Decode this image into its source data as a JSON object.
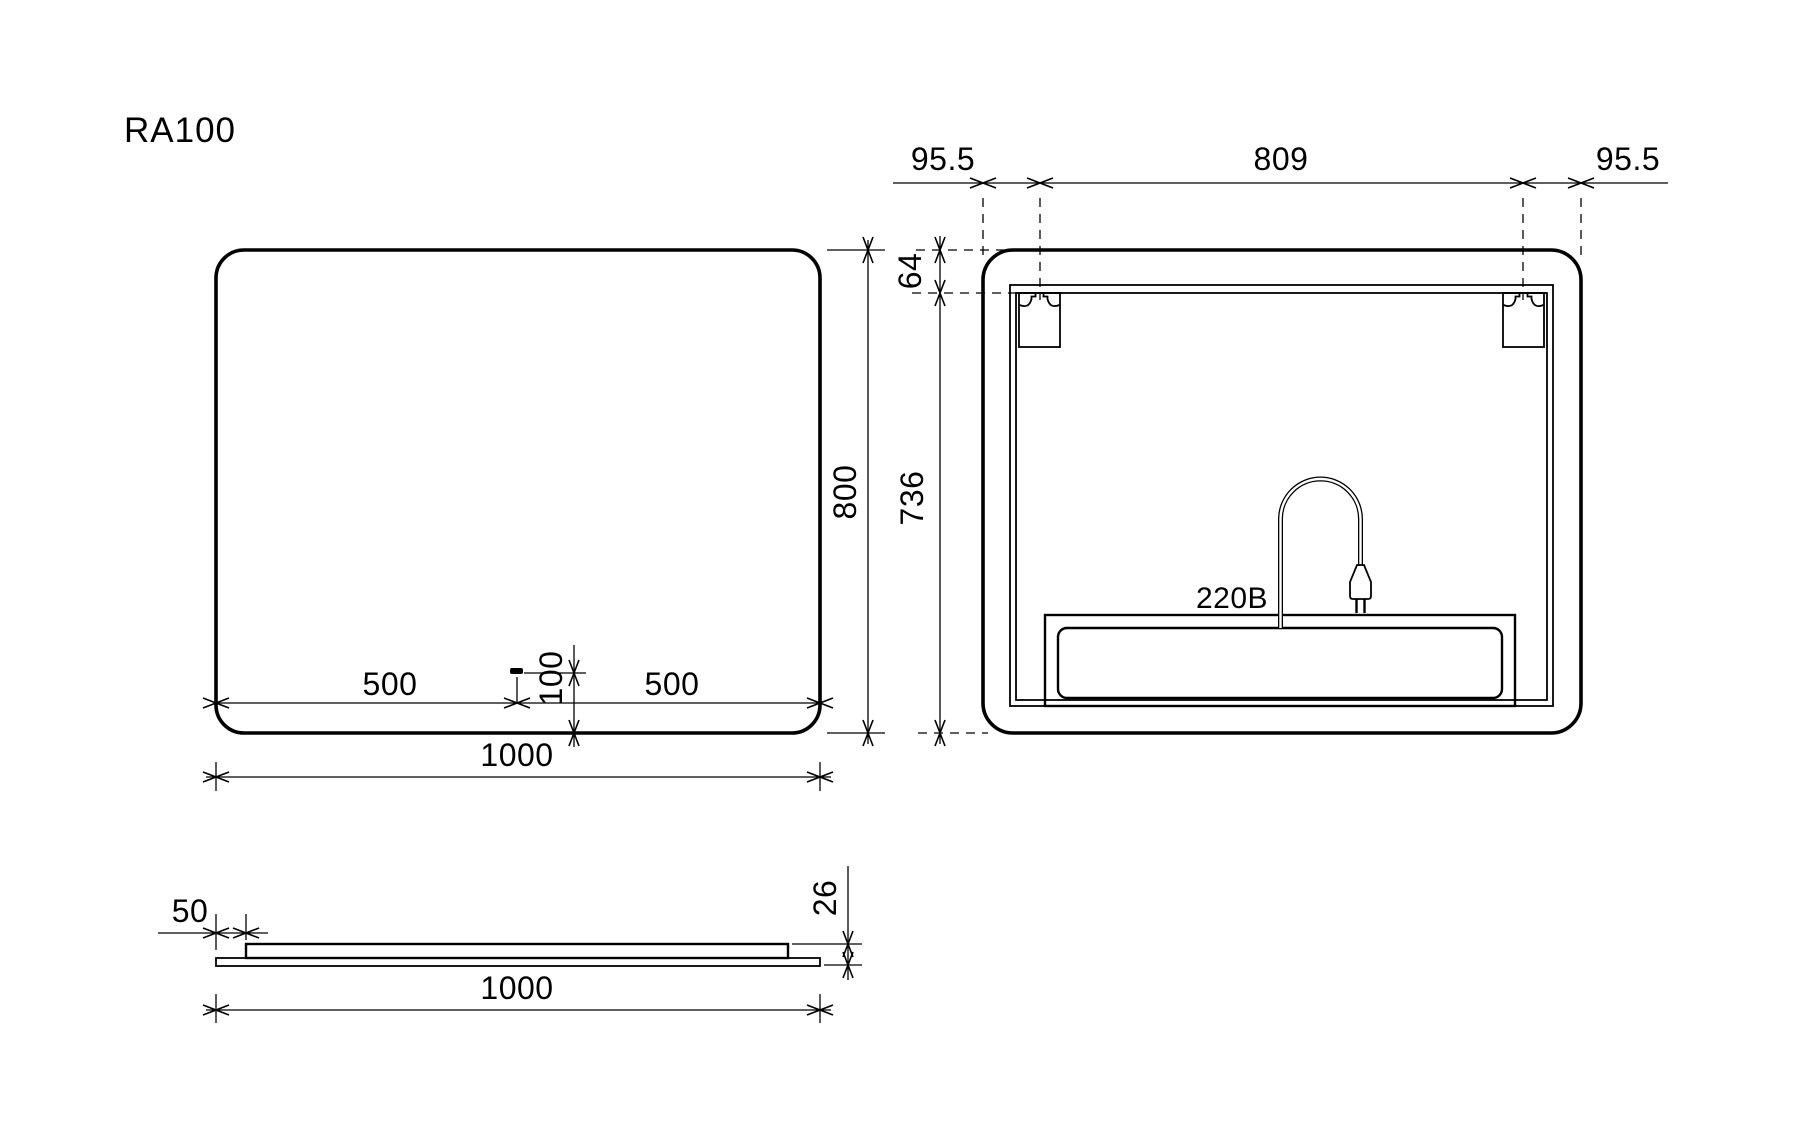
{
  "title": "RA100",
  "front_view": {
    "dim_width": "1000",
    "dim_height": "800",
    "dim_sensor_left": "500",
    "dim_sensor_right": "500",
    "dim_sensor_bottom": "100"
  },
  "back_view": {
    "dim_edge_left": "95.5",
    "dim_brackets": "809",
    "dim_edge_right": "95.5",
    "dim_top": "64",
    "dim_bottom": "736",
    "voltage_label": "220B"
  },
  "side_view": {
    "dim_inset": "50",
    "dim_width": "1000",
    "dim_thickness": "26"
  },
  "colors": {
    "line": "#000000",
    "background": "#ffffff"
  }
}
